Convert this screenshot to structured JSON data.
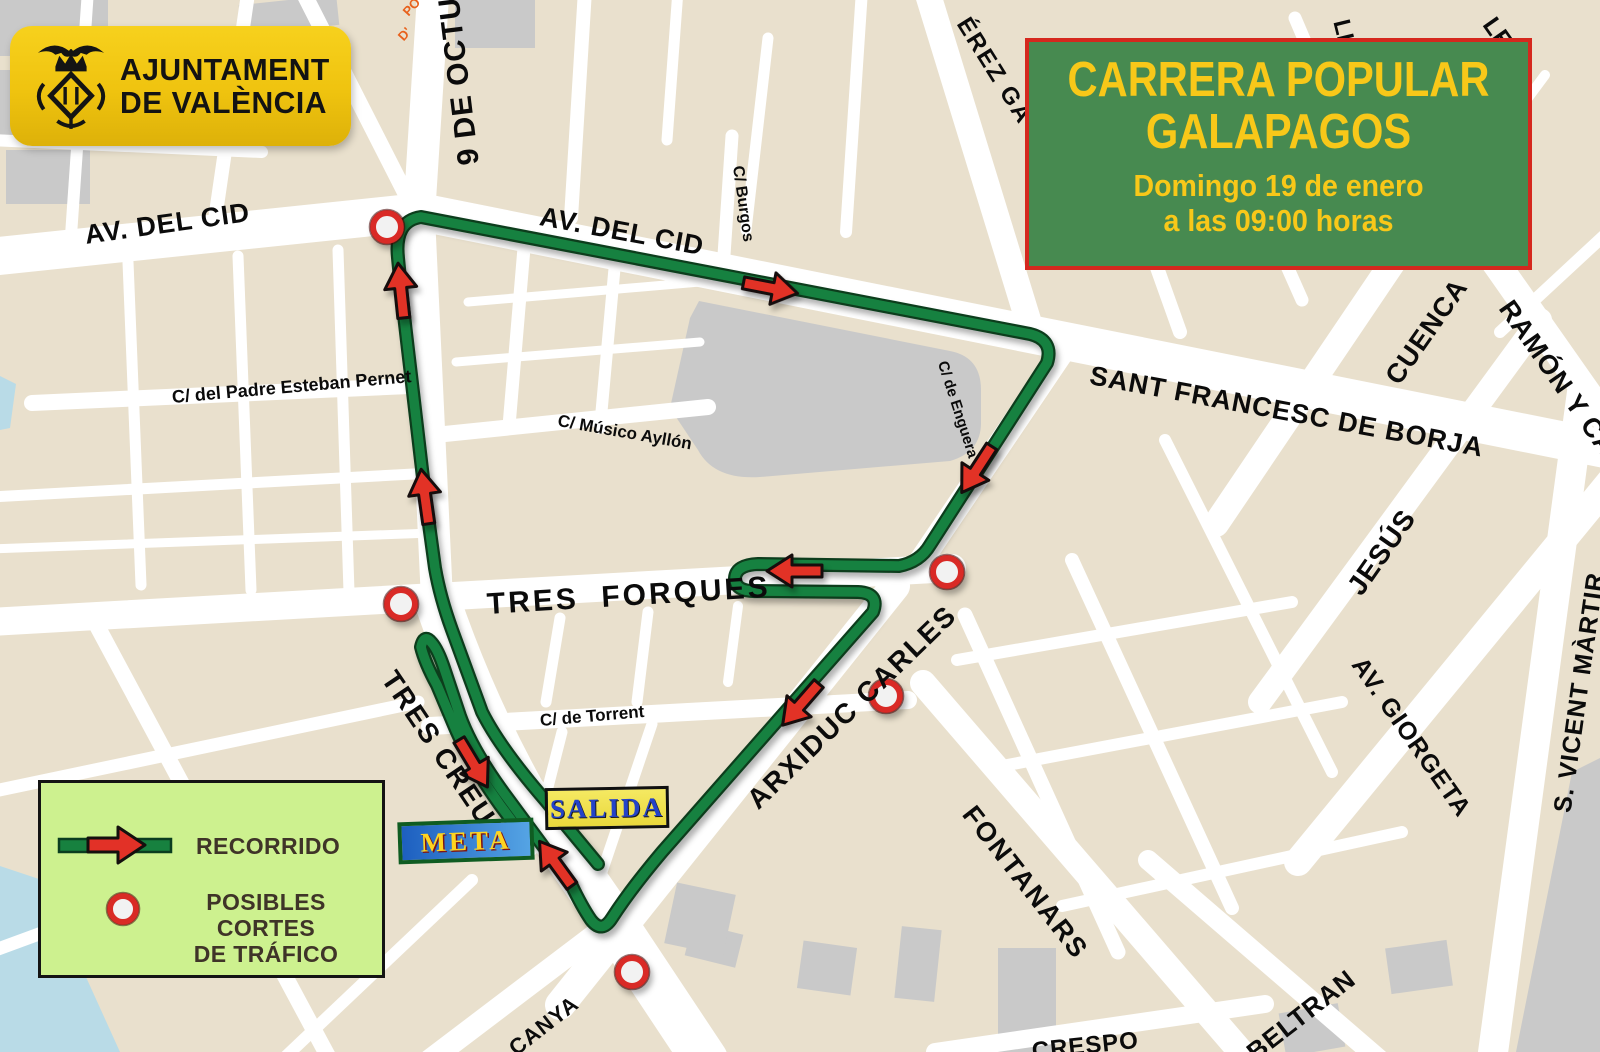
{
  "org_banner": {
    "line1": "AJUNTAMENT",
    "line2": "DE VALÈNCIA"
  },
  "event_box": {
    "title_line1": "CARRERA POPULAR",
    "title_line2": "GALAPAGOS",
    "date": "Domingo 19 de enero",
    "time": "a las 09:00 horas"
  },
  "legend": {
    "route": "RECORRIDO",
    "cuts_line1": "POSIBLES CORTES",
    "cuts_line2": "DE TRÁFICO"
  },
  "markers": {
    "start": "SALIDA",
    "finish": "META"
  },
  "streets": {
    "av_del_cid": "AV. DEL CID",
    "nou_octubre": "9 DE OCTU",
    "burgos": "C/ Burgos",
    "perez_galdos": "ÉREZ GA",
    "sant_francesc": "SANT FRANCESC DE BORJA",
    "cuenca": "CUENCA",
    "ramon_y_cajal": "RAMÓN Y CA",
    "le_fragment": "LE",
    "lic_fragment": "LIC",
    "pol_fragment_line1": "PO",
    "pol_fragment_line2": "D'",
    "jesus": "JESÚS",
    "av_giorgeta": "AV. GIORGETA",
    "sant_vicent": "S. VICENT MÀRTIR",
    "tres_forques": "TRES  FORQUES",
    "tres_creus": "TRES CREUS",
    "arxiduc_carles": "ARXIDUC CARLES",
    "fontanars": "FONTANARS",
    "padre_esteban": "C/ del Padre Esteban Pernet",
    "musico_ayllon": "C/ Músico Ayllón",
    "enguera": "C/ de Enguera",
    "torrent": "C/ de Torrent",
    "canya": "CANYA",
    "crespo": "CRESPO",
    "beltran": "BELTRAN"
  },
  "colors": {
    "route_green": "#17813f",
    "arrow_red": "#e23127",
    "marker_ring": "#d92b25",
    "event_green": "#478a50",
    "event_yellow": "#f8c819",
    "banner_yellow": "#f0c514",
    "legend_bg": "#cdf18f"
  }
}
